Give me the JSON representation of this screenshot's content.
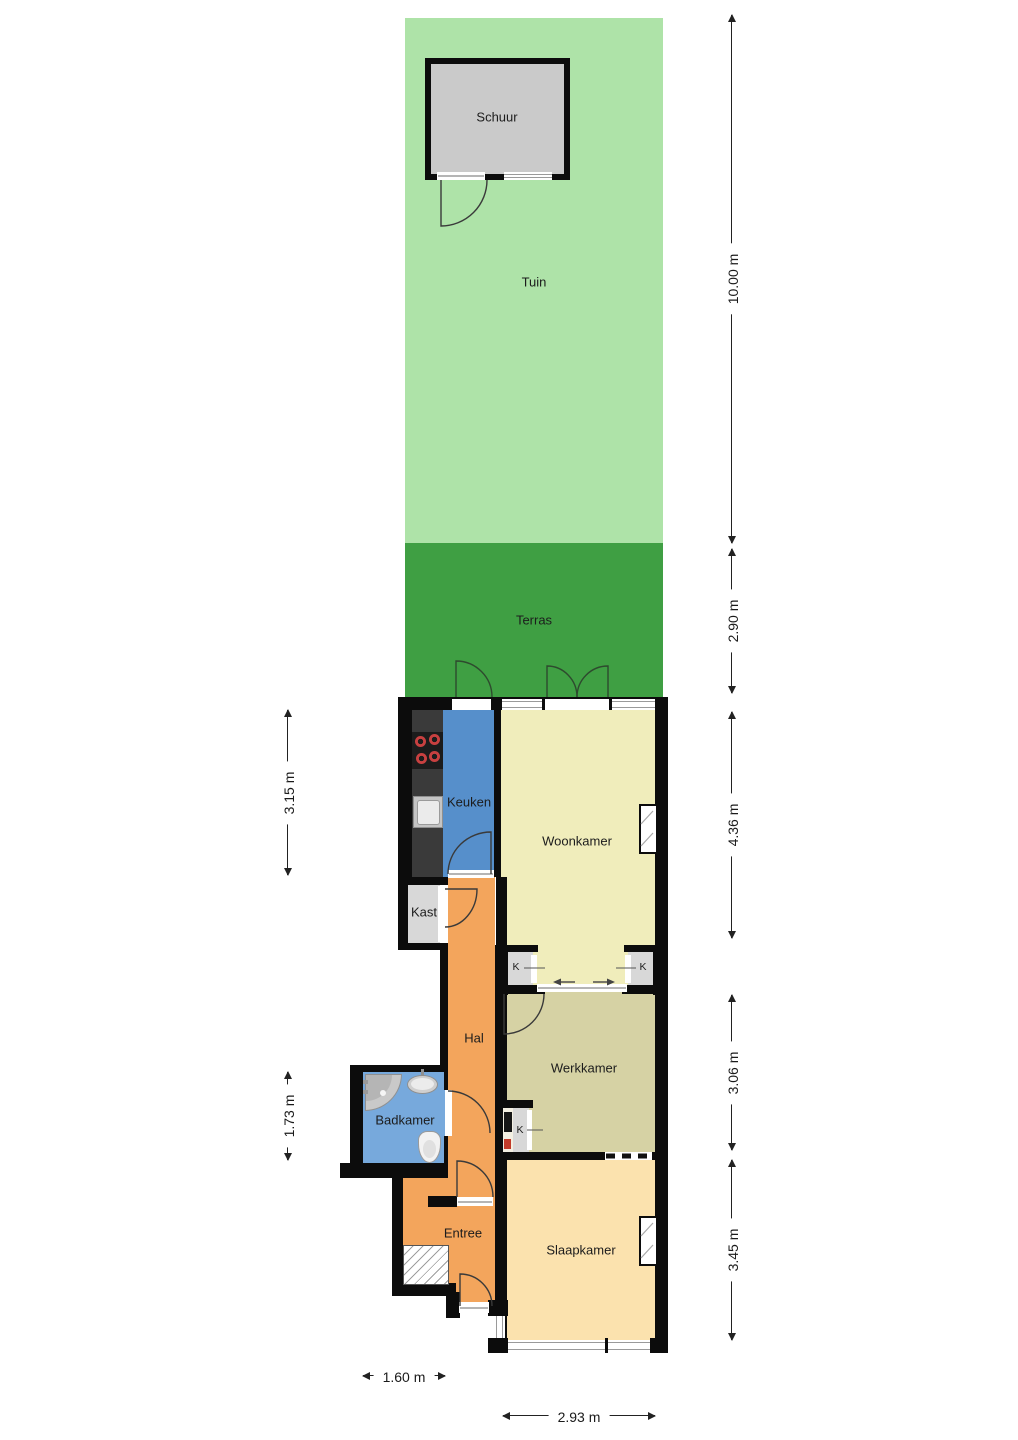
{
  "floorplan": {
    "rooms": {
      "schuur": {
        "label": "Schuur"
      },
      "tuin": {
        "label": "Tuin"
      },
      "terras": {
        "label": "Terras"
      },
      "keuken": {
        "label": "Keuken"
      },
      "woonkamer": {
        "label": "Woonkamer"
      },
      "kast": {
        "label": "Kast"
      },
      "hal": {
        "label": "Hal"
      },
      "werkkamer": {
        "label": "Werkkamer"
      },
      "badkamer": {
        "label": "Badkamer"
      },
      "entree": {
        "label": "Entree"
      },
      "slaapkamer": {
        "label": "Slaapkamer"
      }
    },
    "closets": {
      "k1": "K",
      "k2": "K",
      "k3": "K"
    },
    "dimensions": {
      "right": [
        {
          "label": "10.00 m"
        },
        {
          "label": "2.90 m"
        },
        {
          "label": "4.36 m"
        },
        {
          "label": "3.06 m"
        },
        {
          "label": "3.45 m"
        }
      ],
      "left": [
        {
          "label": "3.15 m"
        },
        {
          "label": "1.73 m"
        }
      ],
      "bottom": [
        {
          "label": "1.60 m"
        },
        {
          "label": "2.93 m"
        }
      ]
    },
    "colors": {
      "garden": "#aee3a8",
      "terrace": "#3f9f43",
      "wall": "#0c0c0c",
      "kitchen": "#568fcb",
      "bathroom": "#77a9dc",
      "living_room": "#f0edbb",
      "study": "#d6d2a4",
      "bedroom": "#fbe2ae",
      "hall": "#f3a55c",
      "closet": "#d8d8d8",
      "shed": "#cacaca",
      "counter": "#3a3a3a"
    },
    "icons": [
      "stove-icon",
      "kitchen-sink-icon",
      "shower-icon",
      "washbasin-icon",
      "toilet-icon",
      "door-arc-icon",
      "window-icon",
      "meter-cabinet-icon"
    ]
  }
}
